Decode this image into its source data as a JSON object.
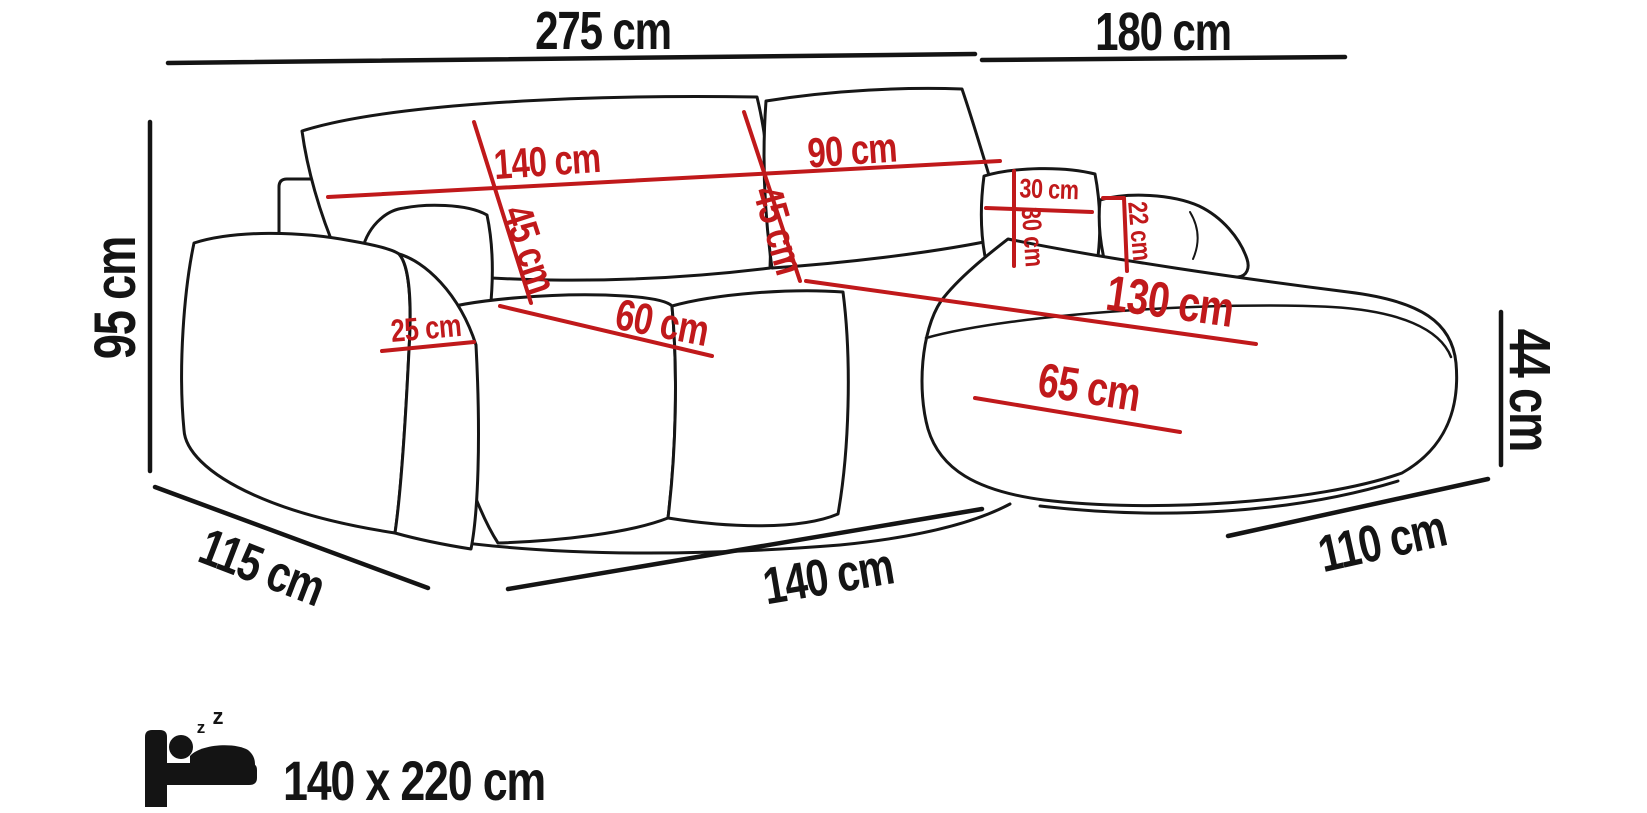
{
  "diagram": {
    "name": "corner-sofa-dimension-diagram",
    "colors": {
      "outline": "#161616",
      "dimension_black": "#141414",
      "dimension_red": "#c0191b",
      "background": "#ffffff"
    },
    "overall_dimensions": {
      "top_left_width": "275 cm",
      "top_right_width": "180 cm",
      "left_height": "95 cm",
      "right_seat_height": "44 cm",
      "bottom_left_depth": "115 cm",
      "bottom_center_width": "140 cm",
      "bottom_right_depth": "110 cm"
    },
    "cushion_dimensions": {
      "left_backrest_width": "140 cm",
      "right_backrest_width": "90 cm",
      "left_backrest_height": "45 cm",
      "right_backrest_height": "45 cm",
      "pillow_width": "30 cm",
      "pillow_height": "30 cm",
      "right_armrest_height": "22 cm",
      "left_armrest_width": "25 cm",
      "seat_depth": "60 cm",
      "chaise_length": "130 cm",
      "chaise_width": "65 cm"
    },
    "sleeping_function": {
      "icon": "sleeping-bed-icon",
      "z_glyph": "z",
      "size_label": "140 x 220 cm"
    }
  }
}
